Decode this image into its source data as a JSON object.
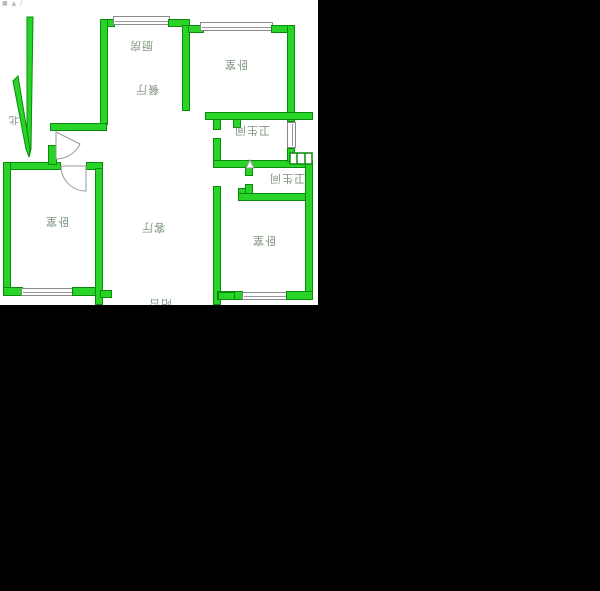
{
  "watermark": "■ ▲ /",
  "north": {
    "label": "北"
  },
  "rooms": {
    "kitchen": "厨房",
    "dining": "餐厅",
    "living": "客厅",
    "bedroom_top": "卧室",
    "bedroom_left": "卧室",
    "bedroom_right": "卧室",
    "bath1": "卫生间",
    "bath2": "卫生间",
    "balcony": "阳台"
  },
  "colors": {
    "wall_green": "#27d427",
    "wall_outline": "#0b8b0b",
    "label_text": "#7e947e",
    "canvas_bg": "#000000",
    "plan_bg": "#ffffff"
  },
  "notes": {
    "labels_rotated_degrees": "180"
  }
}
